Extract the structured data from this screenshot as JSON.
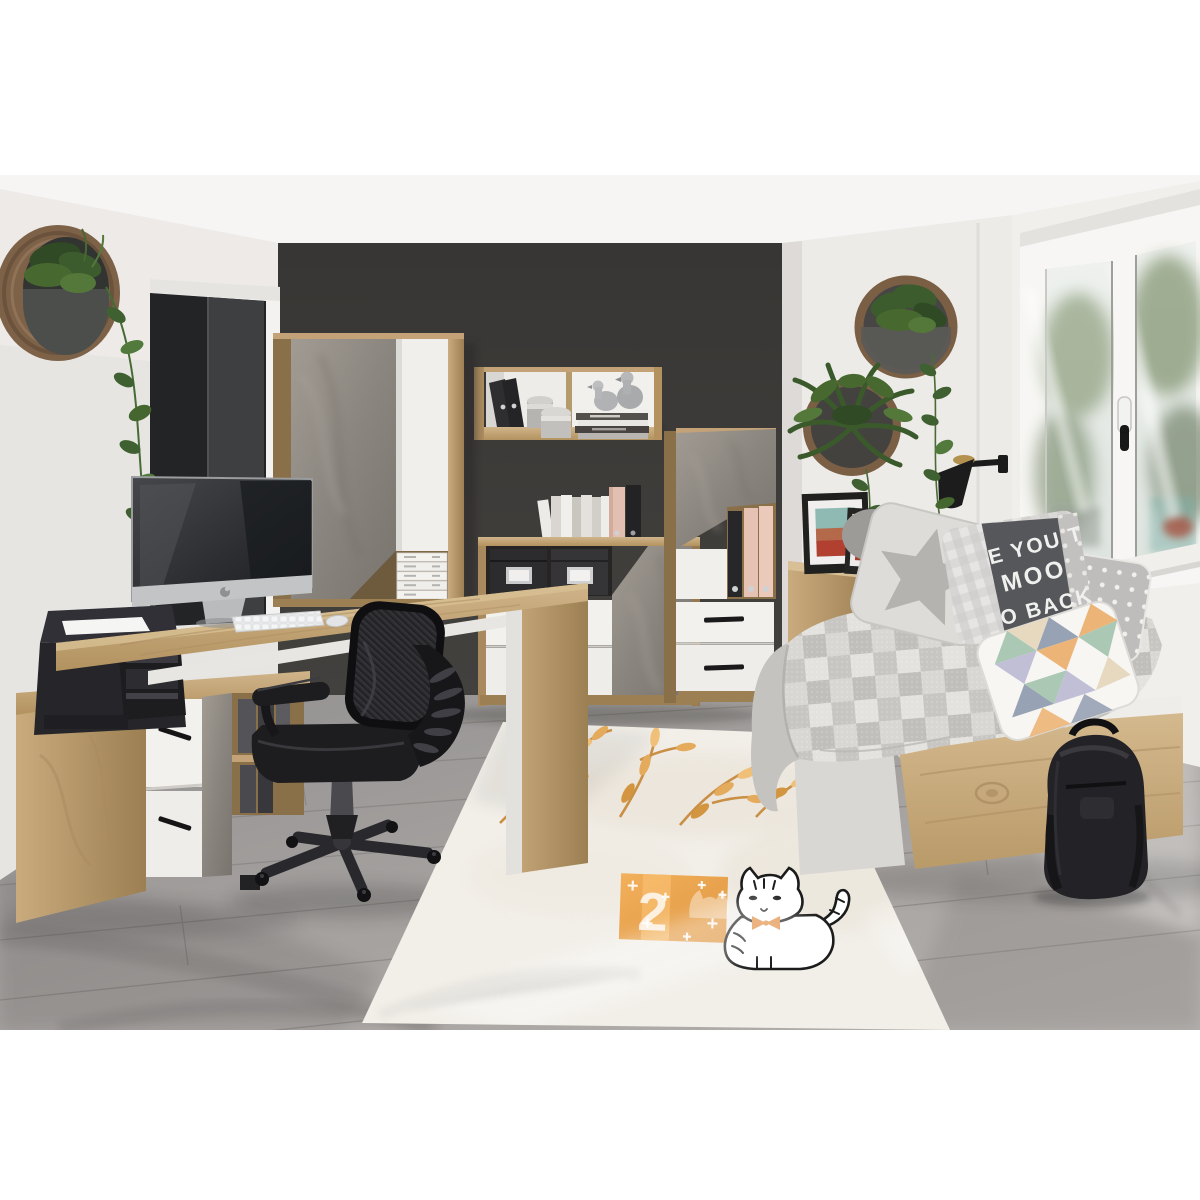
{
  "meta": {
    "image_type": "interior product photograph",
    "scene": "Teen room / home-office furniture set in oak, white and concrete-grey finishes against a dark feature wall"
  },
  "palette": {
    "margin_white": "#ffffff",
    "wall_dark": "#3c3a38",
    "wall_light": "#eae8e5",
    "ceiling": "#f6f5f3",
    "oak": "#c2a276",
    "oak_light": "#d2b88c",
    "concrete_grey": "#8f8a83",
    "furniture_white": "#f3f1ee",
    "floor_grey": "#a6a2a0",
    "rug_cream": "#f2efe9",
    "accent_orange": "#e2a050",
    "plant_green": "#3c5c2e",
    "chair_black": "#1f1f21"
  },
  "objects": [
    "round wooden wall planter with trailing vine",
    "open dark doorway",
    "dark charcoal feature wall",
    "wardrobe with diagonal concrete-effect and white doors",
    "oak wall shelf with binders, canisters and stacked books with silver duck figurines",
    "corner desk with monitor, keyboard and mouse",
    "black printer on low oak sideboard",
    "black mesh swivel office chair",
    "sideboard with black storage boxes and white drawers",
    "tall cabinet with binder niche and white drawers",
    "two round wall planters with fern and pothos",
    "black wall sconce lamp",
    "two framed photographs",
    "oak daybed with grey patchwork quilt and cushions",
    "star cushion, slogan cushion, polka-dot cushion, triangle cushion",
    "black backpack",
    "cream rug with orange watercolour branches, orange tag and cat drawing",
    "white double window with garden view",
    "grey plank flooring"
  ],
  "daybed": {
    "text_pillow_lines": [
      "E YOU T",
      "MOO",
      "O BACK"
    ]
  },
  "rug": {
    "tag_number": "2"
  }
}
